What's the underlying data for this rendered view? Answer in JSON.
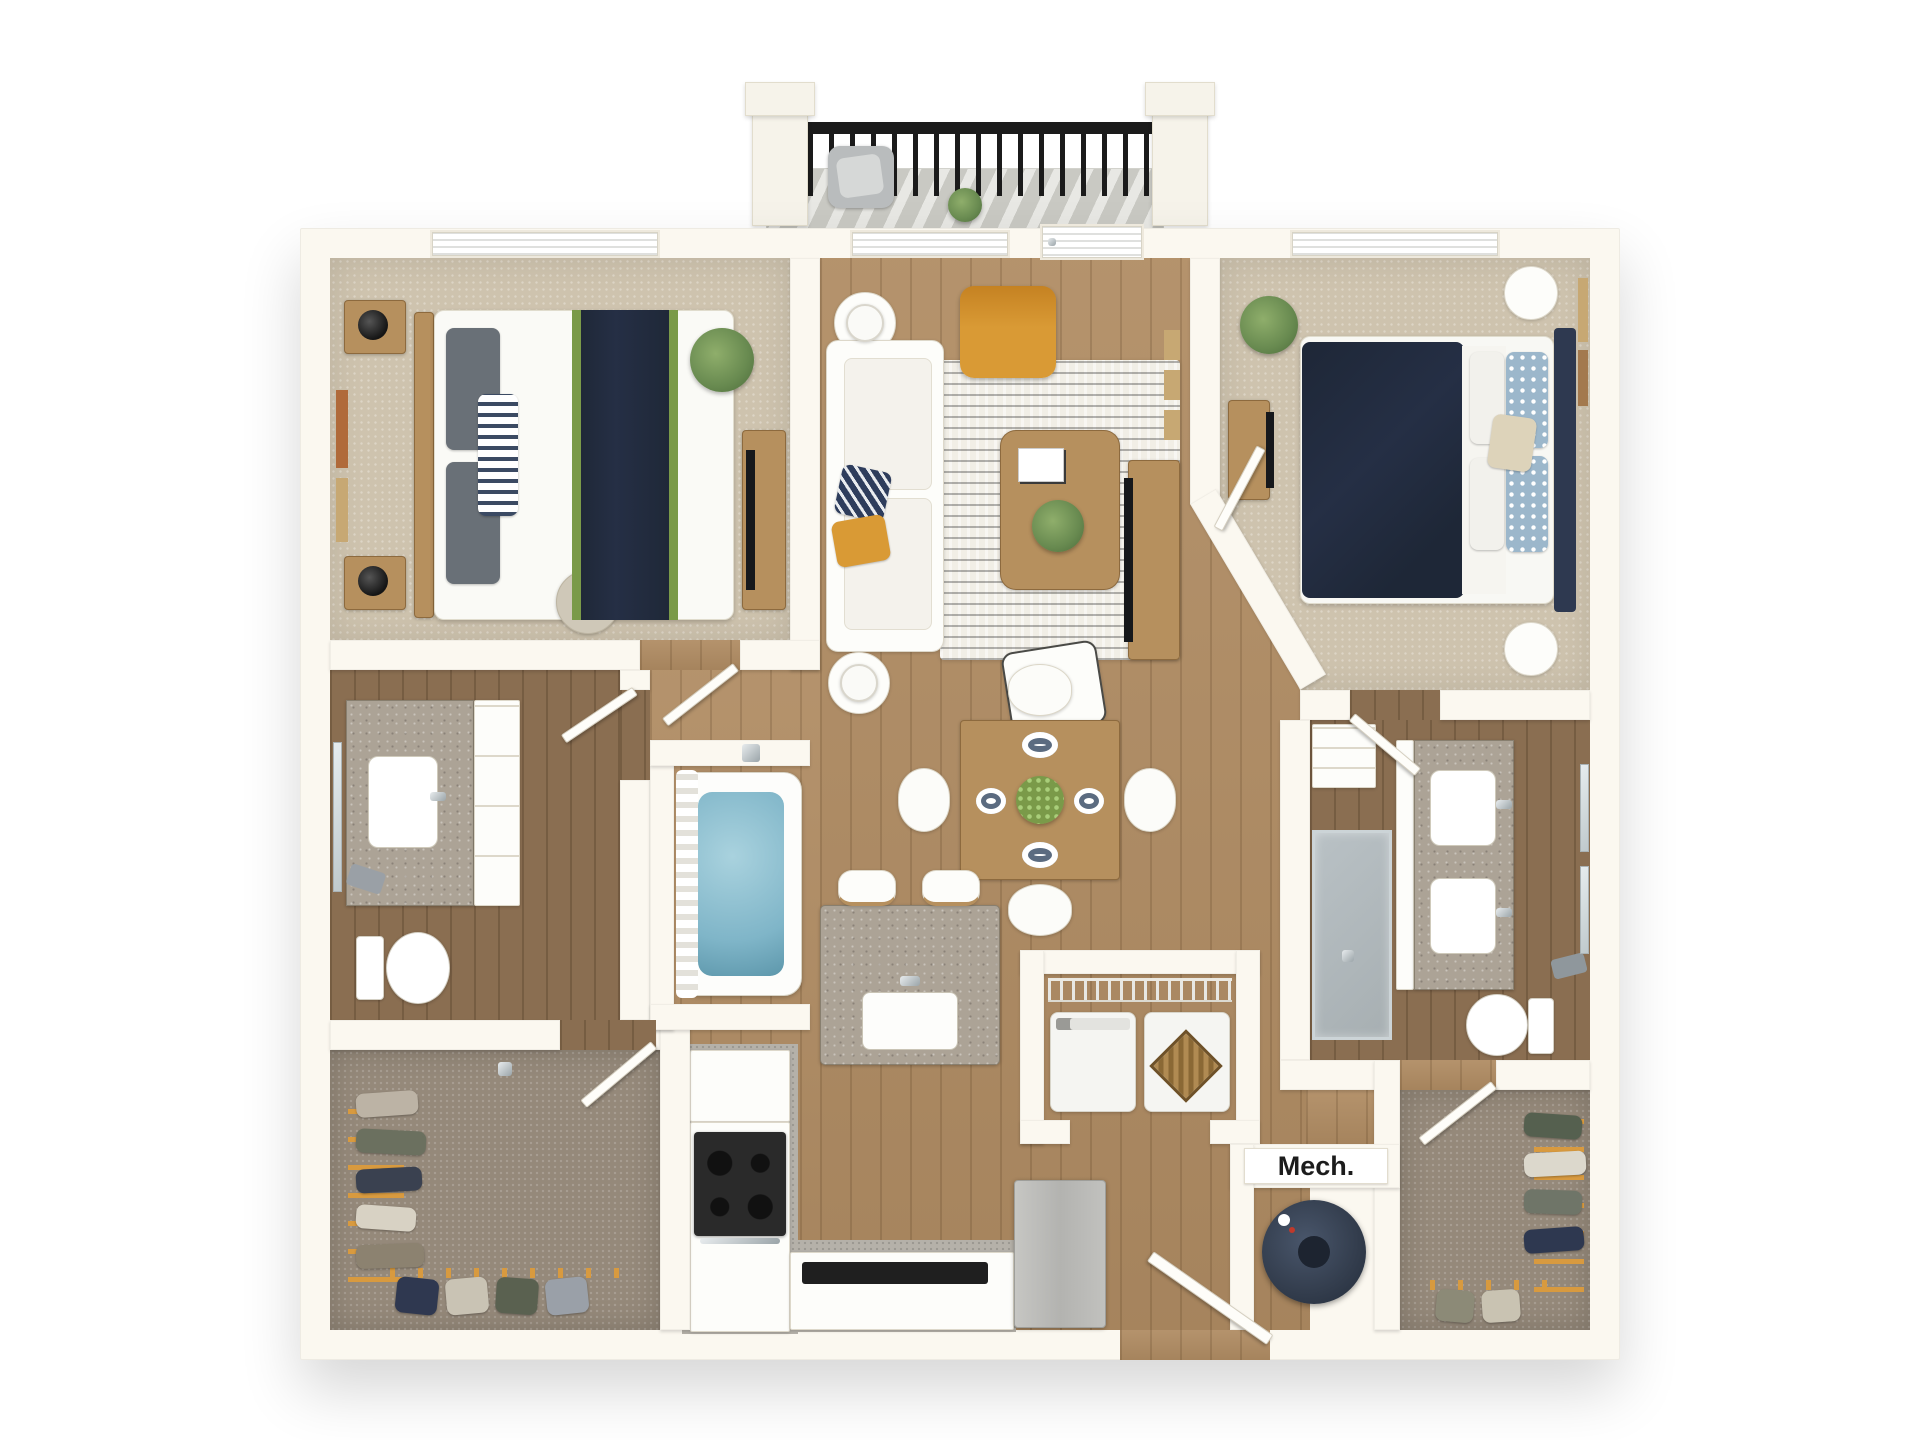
{
  "labels": {
    "mech": "Mech."
  },
  "colors": {
    "wall": "#fbf8f0",
    "wall_edge": "#e6dfd0",
    "carpet": "#cec3ae",
    "carpet_dark": "#95897a",
    "wood": "#b08c63",
    "wood_dark": "#8a6e51",
    "kitchen_floor": "#b5b1a9",
    "granite": "#aca396",
    "rug": "#f1eee6",
    "navy": "#252f45",
    "green": "#7a9a49",
    "plant": "#688a50",
    "mustard": "#d99a35",
    "water": "#7fb5c8",
    "glass": "#ccd4d7",
    "tv": "#16181c",
    "wood_furn": "#b6905e",
    "frame_rust": "#b06a3a",
    "frame_tan": "#c7a873",
    "rail": "#1b1b1b",
    "blue_pillow": "#9cb7cb",
    "cream": "#ddd3ba",
    "gray_pillow": "#697077",
    "hanger": "#d89a3f",
    "label": "#1c1c1c",
    "mech_tank": "#333d4d"
  },
  "plan": {
    "type": "3d-floor-plan-top-view",
    "visible_text": [
      "Mech."
    ],
    "rooms": [
      "balcony",
      "bedroom-1",
      "living-room",
      "bedroom-2",
      "bathroom-1",
      "tub-alcove",
      "hallway",
      "dining-area",
      "bathroom-2",
      "linen-closet",
      "kitchen",
      "laundry-closet",
      "mechanical-room",
      "walk-in-closet-1",
      "walk-in-closet-2",
      "entry"
    ],
    "furnishings": {
      "balcony": [
        "black-metal-railing",
        "white-posts",
        "outdoor-chair",
        "potted-plant",
        "striped-deck"
      ],
      "bedroom_1": [
        "queen-bed-white-duvet-navy-runner",
        "striped-pillow",
        "nightstands-2",
        "black-lamps-2",
        "wall-art-2",
        "palm-plant",
        "dresser-with-tv",
        "accent-chair",
        "window-blinds"
      ],
      "living_room": [
        "white-sectional-sofa",
        "navy-pillow",
        "mustard-pillow",
        "round-side-tables-2",
        "white-lamps-2",
        "mustard-armchair",
        "patterned-rug",
        "wood-coffee-table",
        "book",
        "plant-centerpiece",
        "white-accent-chair",
        "media-console-tv",
        "gallery-frames",
        "window",
        "balcony-door"
      ],
      "bedroom_2": [
        "queen-bed-navy-duvet",
        "blue-patterned-pillows",
        "cream-pillow",
        "round-nightstands-2",
        "dresser-with-tv",
        "plant",
        "wall-art-2",
        "window-blinds"
      ],
      "bathroom_1": [
        "vanity-granite-sink",
        "mirror",
        "toilet",
        "towel",
        "tub-with-water",
        "shower-curtain"
      ],
      "bathroom_2": [
        "double-granite-vanity",
        "two-sinks",
        "two-mirrors",
        "walk-in-glass-shower",
        "toilet",
        "linen-shelves"
      ],
      "kitchen": [
        "upper-cabinets",
        "range-stove-4-burners",
        "counter-run",
        "black-counter-appliance",
        "island-granite",
        "island-sink-faucet",
        "bar-stools-2",
        "refrigerator"
      ],
      "dining": [
        "round-wood-table",
        "white-chairs-4",
        "place-settings-4",
        "green-centerpiece"
      ],
      "laundry": [
        "wire-shelf",
        "washer",
        "dryer",
        "wicker-basket"
      ],
      "mechanical": [
        "water-heater-tank",
        "mech-label"
      ],
      "closets": [
        "hanging-clothes",
        "orange-hangers",
        "carpet"
      ]
    }
  }
}
